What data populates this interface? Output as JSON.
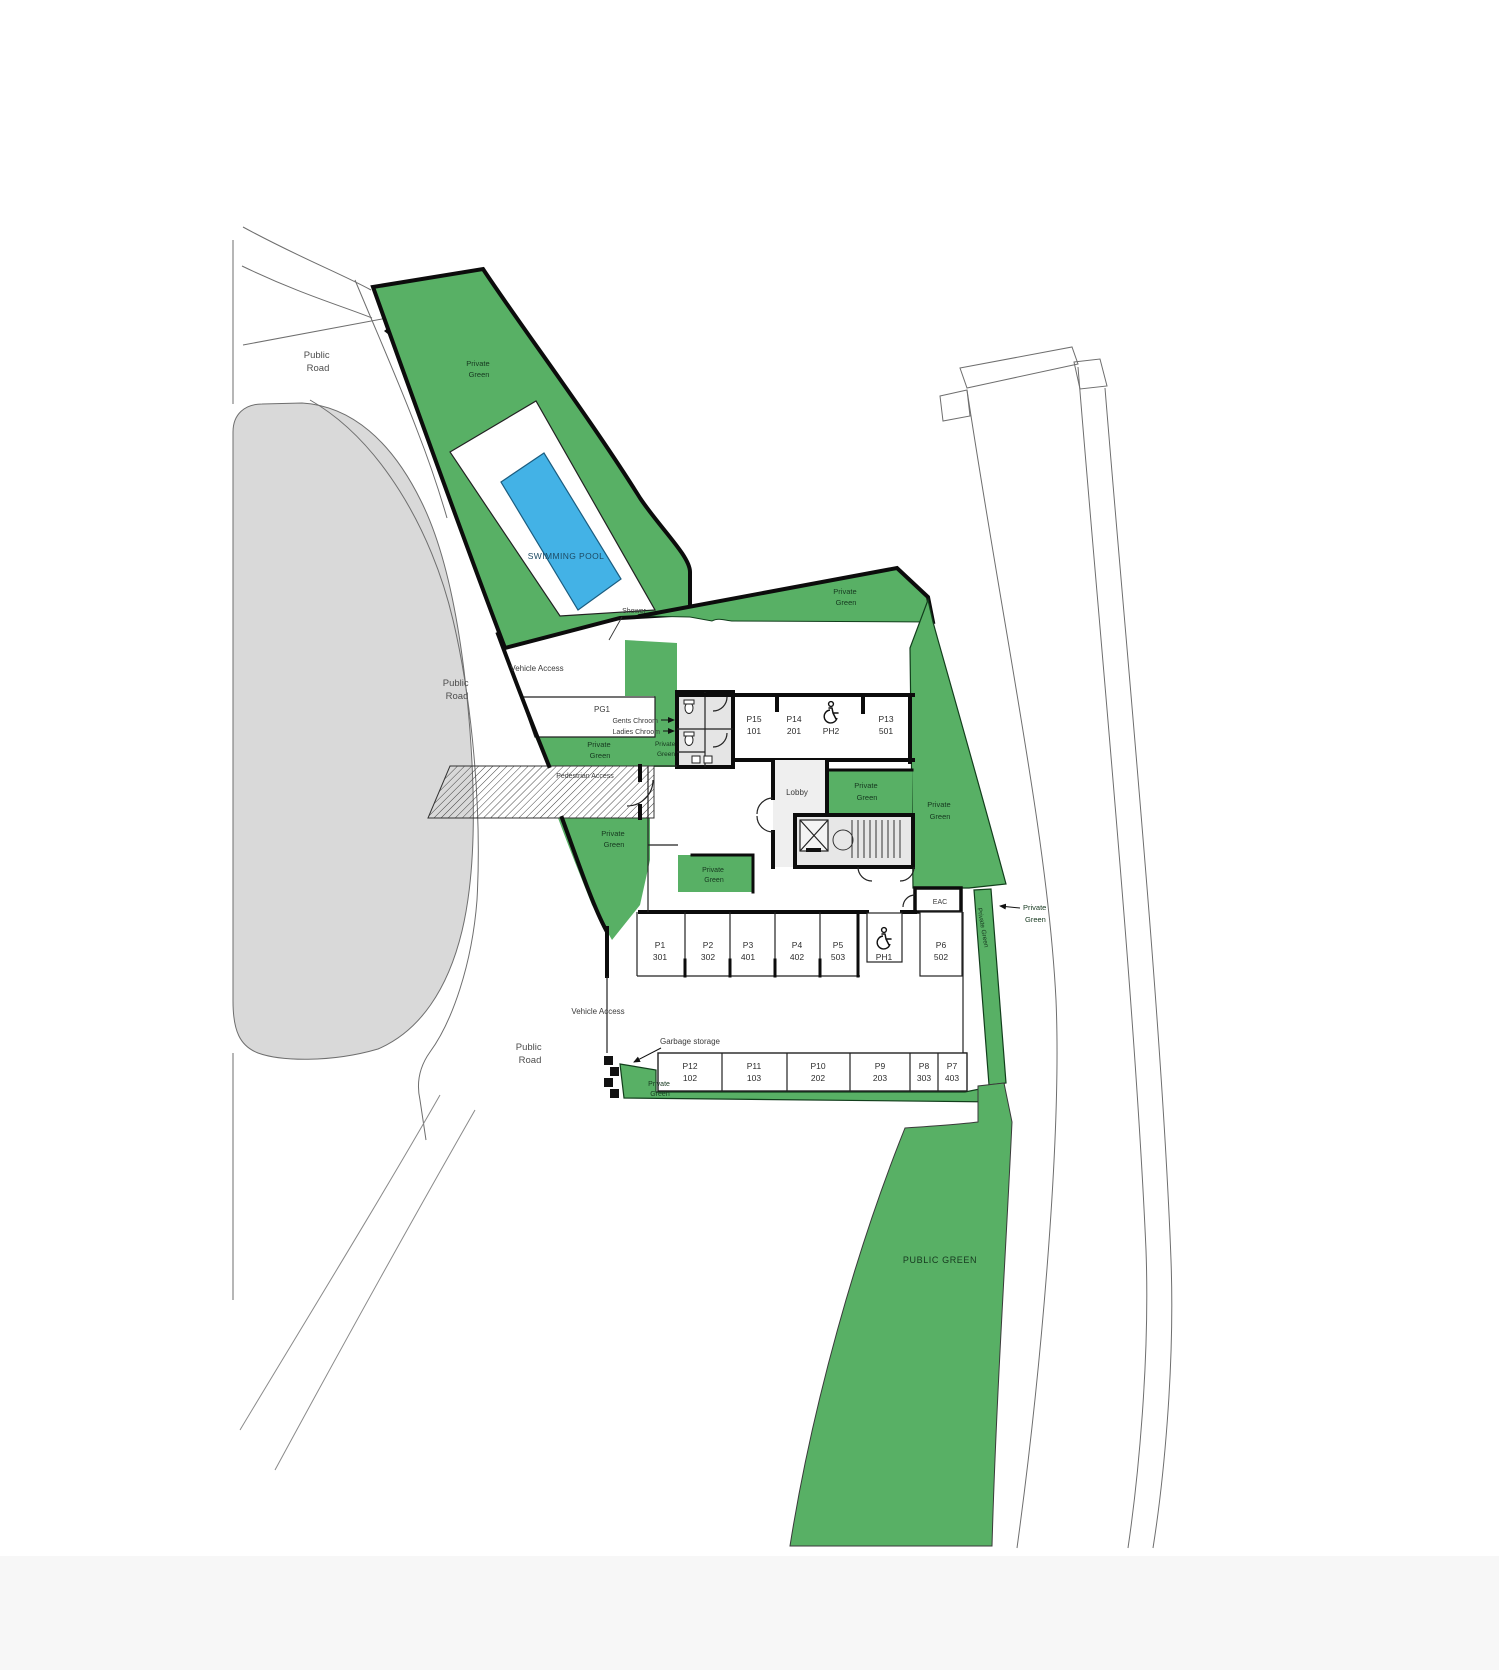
{
  "drawing": {
    "roads": {
      "public_road": "Public Road",
      "public_road_lines": [
        "Public",
        "Road"
      ]
    },
    "green": {
      "private_green": "Private Green",
      "private_green_lines": [
        "Private",
        "Green"
      ],
      "public_green": "PUBLIC GREEN"
    },
    "pool": {
      "swimming_pool": "SWIMMING POOL",
      "shower": "Shower"
    },
    "access": {
      "vehicle_access": "Vehicle Access",
      "pedestrian_access": "Pedestrian Access",
      "garbage_storage": "Garbage storage"
    },
    "rooms": {
      "pg1": "PG1",
      "gents": "Gents Chroom",
      "ladies": "Ladies Chroom",
      "lobby": "Lobby",
      "mep": "MEP",
      "eac": "EAC"
    },
    "parking": {
      "row_upper": [
        {
          "id": "P15",
          "unit": "101"
        },
        {
          "id": "P14",
          "unit": "201"
        },
        {
          "id": "PH2",
          "unit": "",
          "accessible": true
        },
        {
          "id": "P13",
          "unit": "501"
        }
      ],
      "row_middle": [
        {
          "id": "P1",
          "unit": "301"
        },
        {
          "id": "P2",
          "unit": "302"
        },
        {
          "id": "P3",
          "unit": "401"
        },
        {
          "id": "P4",
          "unit": "402"
        },
        {
          "id": "P5",
          "unit": "503"
        },
        {
          "id": "PH1",
          "unit": "",
          "accessible": true
        },
        {
          "id": "P6",
          "unit": "502"
        }
      ],
      "row_lower": [
        {
          "id": "P12",
          "unit": "102"
        },
        {
          "id": "P11",
          "unit": "103"
        },
        {
          "id": "P10",
          "unit": "202"
        },
        {
          "id": "P9",
          "unit": "203"
        },
        {
          "id": "P8",
          "unit": "303"
        },
        {
          "id": "P7",
          "unit": "403"
        }
      ]
    },
    "colors": {
      "green": "#58b065",
      "pool_blue": "#43b2e6",
      "road_gray": "#d9d9d9",
      "wall_black": "#0c0c0c",
      "core_gray": "#e7e7e7"
    }
  }
}
